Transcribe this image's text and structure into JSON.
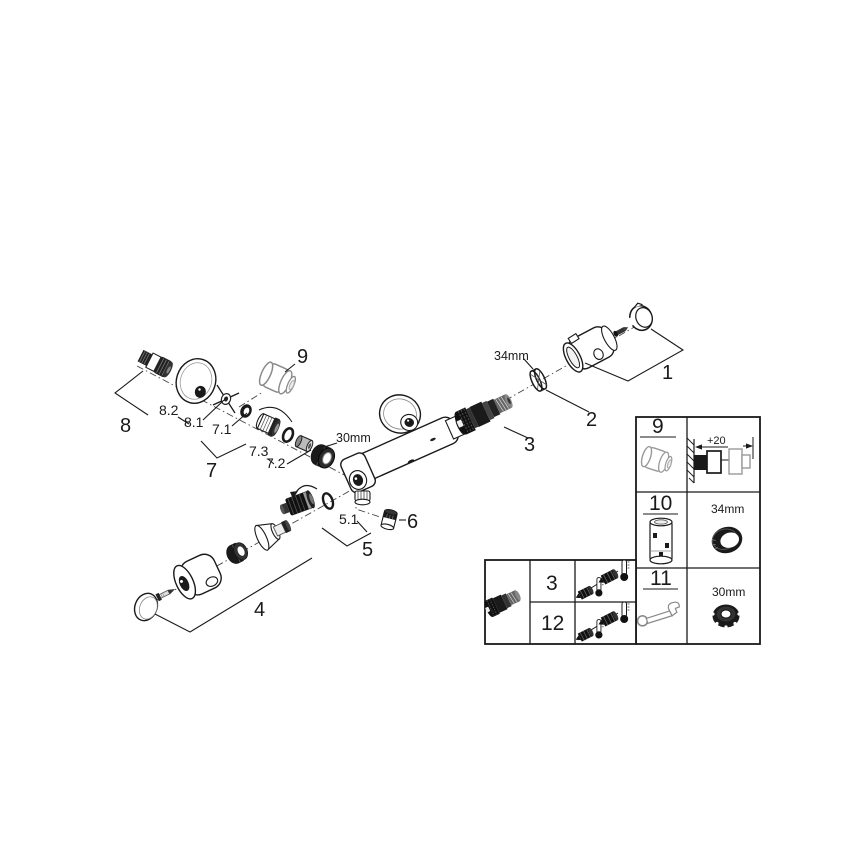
{
  "exploded_view": {
    "callouts": {
      "c1": "1",
      "c2": "2",
      "c3": "3",
      "c4": "4",
      "c5": "5",
      "c5_1": "5.1",
      "c6": "6",
      "c7": "7",
      "c7_1": "7.1",
      "c7_2": "7.2",
      "c7_3": "7.3",
      "c8": "8",
      "c8_1": "8.1",
      "c8_2": "8.2",
      "c9": "9"
    },
    "dimensions": {
      "outlet_nut": "30mm",
      "cartridge_ring": "34mm"
    },
    "icons": [
      "s-union-icon",
      "wall-escutcheon-icon",
      "cross-seal-icon",
      "temperature-knob-icon",
      "union-nut-30-icon",
      "mixer-body-icon",
      "thermostatic-cartridge-icon",
      "collar-ring-34-icon",
      "handle-holder-icon",
      "handle-cap-icon",
      "check-valve-icon",
      "o-ring-icon",
      "plug-screw-icon",
      "flow-handle-cap-icon",
      "flow-handle-body-icon",
      "knurled-ring-icon",
      "cone-adapter-icon"
    ]
  },
  "info_table": {
    "rows": [
      {
        "ref": "9",
        "icon": "temperature-knob-icon",
        "detail_label": "+20",
        "detail_icon": "wall-extension-diagram"
      },
      {
        "ref": "10",
        "icon": "extension-nipple-icon",
        "detail_label": "34mm",
        "detail_icon": "collar-ring-icon"
      },
      {
        "ref": "11",
        "icon": "open-end-wrench-icon",
        "detail_label": "30mm",
        "detail_icon": "cap-nut-icon"
      }
    ]
  },
  "service_table": {
    "item_icon": "thermostatic-cartridge-icon",
    "rows": [
      {
        "ref": "3",
        "icon": "check-valve-thermometer-icon"
      },
      {
        "ref": "12",
        "icon": "check-valve-thermometer-icon"
      }
    ]
  }
}
